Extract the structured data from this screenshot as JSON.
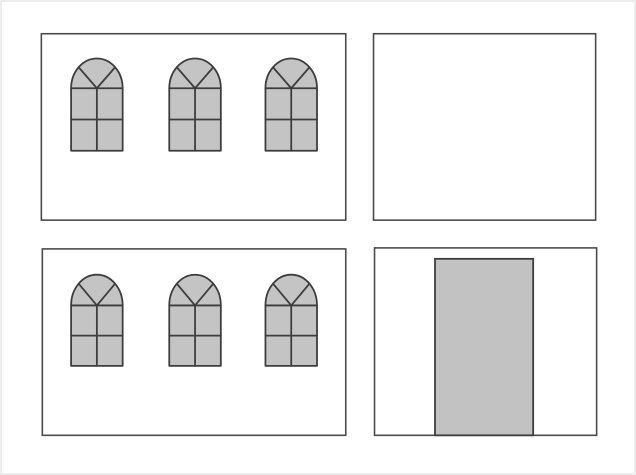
{
  "figure": {
    "description": "Four building-facade panels: top-left wall with three arched windows, top-right empty wall, bottom-left wall with three arched windows, bottom-right wall with a door",
    "background_color": "#ffffff",
    "frame_color": "#ededed",
    "window_count_total": 6,
    "door_count_total": 1
  },
  "styles": {
    "panel_fill": "#ffffff",
    "panel_stroke": "#4a4a4a",
    "panel_stroke_width": 1.6,
    "window_fill": "#c4c4c4",
    "window_stroke": "#3d3d3d",
    "window_stroke_width": 1.8,
    "door_fill": "#c2c2c2",
    "door_stroke": "#3d3d3d",
    "door_stroke_width": 1.8
  },
  "panels": [
    {
      "id": "top-left",
      "label": "wall with three arched windows",
      "x": 39,
      "y": 32,
      "width": 307,
      "height": 188,
      "windows": [
        {
          "x": 69,
          "y": 57,
          "width": 52,
          "height": 93,
          "arch_height": 30
        },
        {
          "x": 168,
          "y": 57,
          "width": 52,
          "height": 93,
          "arch_height": 30
        },
        {
          "x": 265,
          "y": 57,
          "width": 52,
          "height": 93,
          "arch_height": 30
        }
      ],
      "door": null
    },
    {
      "id": "top-right",
      "label": "empty wall",
      "x": 374,
      "y": 32,
      "width": 224,
      "height": 188,
      "windows": [],
      "door": null
    },
    {
      "id": "bottom-left",
      "label": "wall with three arched windows",
      "x": 40,
      "y": 249,
      "width": 306,
      "height": 188,
      "windows": [
        {
          "x": 69,
          "y": 275,
          "width": 52,
          "height": 92,
          "arch_height": 31
        },
        {
          "x": 168,
          "y": 275,
          "width": 52,
          "height": 92,
          "arch_height": 31
        },
        {
          "x": 265,
          "y": 275,
          "width": 52,
          "height": 92,
          "arch_height": 31
        }
      ],
      "door": null
    },
    {
      "id": "bottom-right",
      "label": "wall with door",
      "x": 375,
      "y": 248,
      "width": 224,
      "height": 189,
      "windows": [],
      "door": {
        "x": 436,
        "y": 259,
        "width": 99,
        "height": 178
      }
    }
  ]
}
